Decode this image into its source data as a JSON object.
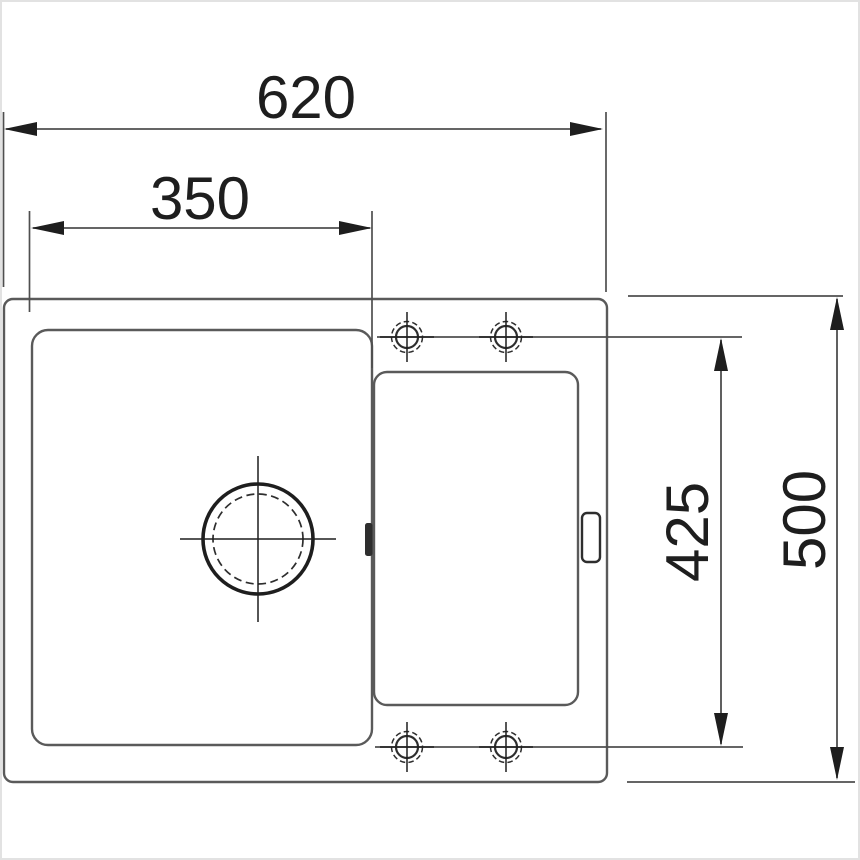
{
  "diagram": {
    "kind": "sink-installation-drawing-top-view",
    "dimensions": {
      "overall_width": {
        "label": "620"
      },
      "bowl_width": {
        "label": "350"
      },
      "tap_hole_span": {
        "label": "425"
      },
      "overall_depth": {
        "label": "500"
      }
    },
    "colors": {
      "bg": "#ffffff",
      "frame": "#e2e2e2",
      "outline": "#5a5a5a",
      "dim": "#4f4f4f",
      "ink": "#1e1e1e",
      "ink2": "#2e2e2e"
    }
  }
}
